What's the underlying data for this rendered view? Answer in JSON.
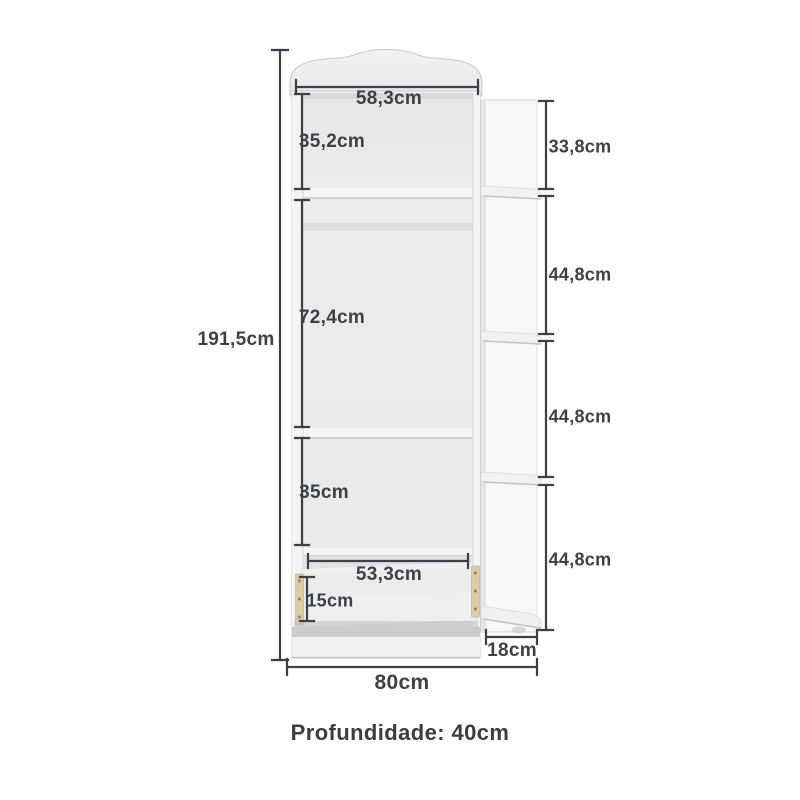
{
  "diagram": {
    "kind": "furniture-dimension-diagram",
    "product": "wardrobe-with-side-shelves",
    "dims": {
      "total_height": "191,5cm",
      "top_inner_width": "58,3cm",
      "top_section": "35,2cm",
      "middle_section": "72,4cm",
      "lower_section": "35cm",
      "drawer_width": "53,3cm",
      "drawer_height": "15cm",
      "side_section_top": "33,8cm",
      "side_section_2": "44,8cm",
      "side_section_3": "44,8cm",
      "side_section_4": "44,8cm",
      "side_width": "18cm",
      "total_width": "80cm"
    },
    "footer": {
      "depth": "Profundidade: 40cm"
    },
    "colors": {
      "background": "#ffffff",
      "dimension_line": "#3d4046",
      "label_text": "#3d4046",
      "furniture_light": "#f2f3f4",
      "furniture_interior": "#e9ebec",
      "furniture_shadow": "#caccce",
      "drawer_rail": "#d9cca7"
    }
  }
}
